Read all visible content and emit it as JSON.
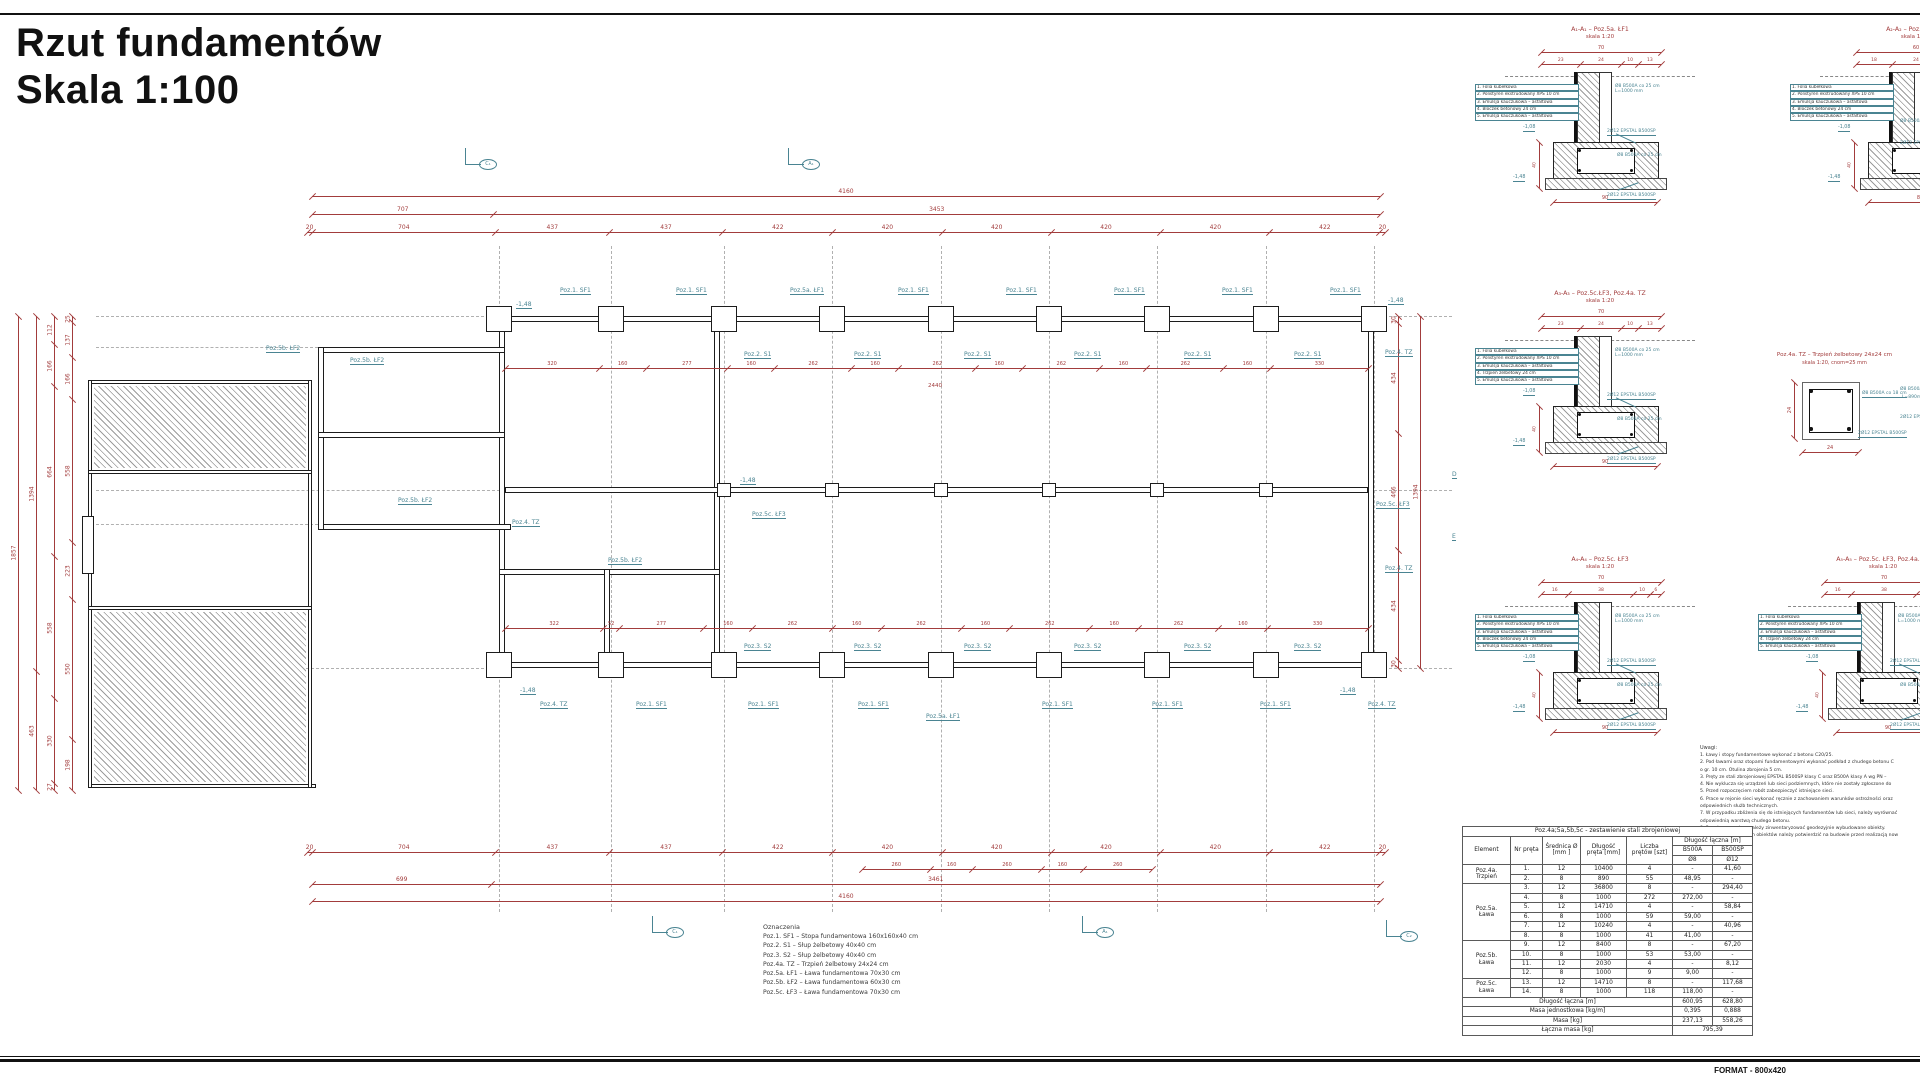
{
  "colors": {
    "dim_red": "#A23C3C",
    "annot_teal": "#4A8492",
    "line": "#1C1C1C",
    "grid": "#B0B0B0"
  },
  "header": {
    "title_line1": "Rzut fundamentów",
    "title_line2": "Skala 1:100"
  },
  "footer": {
    "format_label": "FORMAT - 800x420"
  },
  "plan": {
    "h_chains": [
      {
        "x": 312,
        "y": 196,
        "w": 1068,
        "vals": [
          "4160"
        ]
      },
      {
        "x": 312,
        "y": 214,
        "w": 1068,
        "vals": [
          "707",
          "3453"
        ]
      },
      {
        "x": 307,
        "y": 232,
        "w": 1078,
        "vals": [
          "20",
          "704",
          "437",
          "437",
          "422",
          "420",
          "420",
          "420",
          "420",
          "422",
          "20"
        ]
      },
      {
        "x": 307,
        "y": 852,
        "w": 1078,
        "vals": [
          "20",
          "704",
          "437",
          "437",
          "422",
          "420",
          "420",
          "420",
          "420",
          "422",
          "20"
        ]
      },
      {
        "x": 862,
        "y": 869,
        "w": 290,
        "vals": [
          "260",
          "160",
          "260",
          "160",
          "260"
        ],
        "fs": 5
      },
      {
        "x": 312,
        "y": 884,
        "w": 1068,
        "vals": [
          "699",
          "3461"
        ]
      },
      {
        "x": 312,
        "y": 901,
        "w": 1068,
        "vals": [
          "4160"
        ]
      },
      {
        "x": 505,
        "y": 368,
        "w": 863,
        "vals": [
          "320",
          "160",
          "277",
          "160",
          "262",
          "160",
          "262",
          "160",
          "262",
          "160",
          "262",
          "160",
          "330"
        ],
        "fs": 5
      },
      {
        "x": 505,
        "y": 628,
        "w": 863,
        "vals": [
          "322",
          "52",
          "277",
          "160",
          "262",
          "160",
          "262",
          "160",
          "262",
          "160",
          "262",
          "160",
          "330"
        ],
        "fs": 5
      }
    ],
    "v_chains": [
      {
        "x": 18,
        "y": 316,
        "h": 474,
        "vals": [
          "1857"
        ]
      },
      {
        "x": 36,
        "y": 316,
        "h": 474,
        "vals": [
          "1394",
          "463"
        ]
      },
      {
        "x": 54,
        "y": 316,
        "h": 474,
        "vals": [
          "112",
          "166",
          "664",
          "558",
          "330",
          "27"
        ]
      },
      {
        "x": 72,
        "y": 316,
        "h": 474,
        "vals": [
          "25",
          "137",
          "166",
          "558",
          "223",
          "550",
          "198"
        ]
      },
      {
        "x": 1398,
        "y": 316,
        "h": 352,
        "vals": [
          "30",
          "434",
          "466",
          "434",
          "30"
        ]
      },
      {
        "x": 1420,
        "y": 316,
        "h": 352,
        "vals": [
          "1394"
        ]
      }
    ],
    "grid_cols": {
      "xs": [
        499,
        611,
        724,
        832,
        941,
        1049,
        1157,
        1266,
        1374
      ],
      "y1": 246,
      "y2": 912
    },
    "grid_rows": [
      [
        96,
        316,
        499
      ],
      [
        96,
        490,
        505
      ],
      [
        96,
        668,
        499
      ],
      [
        96,
        347,
        318
      ],
      [
        96,
        524,
        318
      ],
      [
        1374,
        316,
        1452
      ],
      [
        1374,
        490,
        1452
      ],
      [
        1374,
        668,
        1452
      ]
    ],
    "walls": [
      [
        499,
        316,
        875,
        6
      ],
      [
        499,
        662,
        875,
        6
      ],
      [
        499,
        316,
        6,
        352
      ],
      [
        1368,
        316,
        6,
        352
      ],
      [
        714,
        316,
        6,
        352
      ],
      [
        499,
        569,
        221,
        6
      ],
      [
        604,
        569,
        6,
        99
      ],
      [
        505,
        487,
        863,
        6
      ],
      [
        318,
        347,
        187,
        6
      ],
      [
        318,
        524,
        193,
        6
      ],
      [
        318,
        347,
        6,
        183
      ],
      [
        318,
        432,
        187,
        6
      ],
      [
        88,
        380,
        224,
        4
      ],
      [
        88,
        784,
        228,
        4
      ],
      [
        88,
        380,
        4,
        408
      ],
      [
        308,
        380,
        4,
        408
      ],
      [
        88,
        470,
        224,
        4
      ],
      [
        88,
        606,
        224,
        4
      ],
      [
        82,
        516,
        12,
        58
      ]
    ],
    "hatch_areas": [
      [
        94,
        386,
        212,
        82
      ],
      [
        94,
        612,
        212,
        170
      ]
    ],
    "footings": {
      "size": 26,
      "top_y": 319,
      "bottom_y": 665,
      "mid_y": 490,
      "top_xs": [
        499,
        611,
        724,
        832,
        941,
        1049,
        1157,
        1266,
        1374
      ],
      "bottom_xs": [
        499,
        611,
        724,
        832,
        941,
        1049,
        1157,
        1266,
        1374
      ],
      "mid_xs": [
        724,
        832,
        941,
        1049,
        1157,
        1266
      ]
    },
    "labels": [
      [
        "Poz.1. SF1",
        560,
        288
      ],
      [
        "Poz.1. SF1",
        676,
        288
      ],
      [
        "Poz.5a. ŁF1",
        790,
        288
      ],
      [
        "Poz.1. SF1",
        898,
        288
      ],
      [
        "Poz.1. SF1",
        1006,
        288
      ],
      [
        "Poz.1. SF1",
        1114,
        288
      ],
      [
        "Poz.1. SF1",
        1222,
        288
      ],
      [
        "Poz.1. SF1",
        1330,
        288
      ],
      [
        "-1,48",
        516,
        302
      ],
      [
        "-1,48",
        1388,
        298
      ],
      [
        "Poz.5b. ŁF2",
        266,
        346
      ],
      [
        "Poz.5b. ŁF2",
        350,
        358
      ],
      [
        "Poz.5b. ŁF2",
        398,
        498
      ],
      [
        "Poz.5b. ŁF2",
        608,
        558
      ],
      [
        "Poz.2. S1",
        744,
        352
      ],
      [
        "Poz.2. S1",
        854,
        352
      ],
      [
        "Poz.2. S1",
        964,
        352
      ],
      [
        "Poz.2. S1",
        1074,
        352
      ],
      [
        "Poz.2. S1",
        1184,
        352
      ],
      [
        "Poz.2. S1",
        1294,
        352
      ],
      [
        "-1,48",
        740,
        478
      ],
      [
        "Poz.5c. ŁF3",
        752,
        512
      ],
      [
        "Poz.4. TZ",
        512,
        520
      ],
      [
        "Poz.4. TZ",
        1385,
        350
      ],
      [
        "Poz.4. TZ",
        1385,
        566
      ],
      [
        "Poz.5c. ŁF3",
        1376,
        502
      ],
      [
        "Poz.3. S2",
        744,
        644
      ],
      [
        "Poz.3. S2",
        854,
        644
      ],
      [
        "Poz.3. S2",
        964,
        644
      ],
      [
        "Poz.3. S2",
        1074,
        644
      ],
      [
        "Poz.3. S2",
        1184,
        644
      ],
      [
        "Poz.3. S2",
        1294,
        644
      ],
      [
        "-1,48",
        520,
        688
      ],
      [
        "-1,48",
        1340,
        688
      ],
      [
        "Poz.4. TZ",
        540,
        702
      ],
      [
        "Poz.1. SF1",
        636,
        702
      ],
      [
        "Poz.1. SF1",
        748,
        702
      ],
      [
        "Poz.1. SF1",
        858,
        702
      ],
      [
        "Poz.5a. ŁF1",
        926,
        714
      ],
      [
        "Poz.1. SF1",
        1042,
        702
      ],
      [
        "Poz.1. SF1",
        1152,
        702
      ],
      [
        "Poz.1. SF1",
        1260,
        702
      ],
      [
        "Poz.4. TZ",
        1368,
        702
      ],
      [
        "D",
        1452,
        472
      ],
      [
        "E",
        1452,
        534
      ]
    ],
    "red_texts": [
      [
        "2440",
        928,
        384
      ]
    ],
    "flags": [
      [
        "C₁",
        465,
        148
      ],
      [
        "A₁",
        788,
        148
      ],
      [
        "C₁",
        652,
        916
      ],
      [
        "A₁",
        1082,
        916
      ],
      [
        "C₂",
        1386,
        920
      ]
    ]
  },
  "details": {
    "common": {
      "rebar1": "Ø8 B500A co 25 cm",
      "rebar1b": "L=1000 mm",
      "rebar2": "2Ø12 EPSTAL B500SP",
      "rebar3": "Ø8 B500A co 25 cm",
      "rebar4": "2Ø12 EPSTAL B500SP",
      "side_dim": "40",
      "elev_top": "-1,08",
      "elev_bottom": "-1,48"
    },
    "materials_a": [
      "1. Folia kubełkowa",
      "2. Polistyren ekstrudowany XPS 10 cm",
      "3. Emulsja kauczukowa – asfaltowa",
      "4. Bloczek betonowy 24 cm",
      "5. Emulsja kauczukowa – asfaltowa"
    ],
    "materials_b": [
      "1. Folia kubełkowa",
      "2. Polistyren ekstrudowany XPS 10 cm",
      "3. Emulsja kauczukowa – asfaltowa",
      "4. Trzpień żelbetowy 24 cm",
      "5. Emulsja kauczukowa – asfaltowa"
    ],
    "items": [
      {
        "x": 1475,
        "y": 26,
        "title": "A₁-A₁ – Poz.5a. ŁF1",
        "subtitle": "skala 1:20",
        "total": "70",
        "segs": [
          "23",
          "24",
          "10",
          "13"
        ],
        "bottom": "90",
        "mat": "materials_a"
      },
      {
        "x": 1790,
        "y": 26,
        "title": "A₂-A₂ – Poz.5b. ŁF2",
        "subtitle": "skala 1:20",
        "total": "60",
        "segs": [
          "18",
          "24",
          "10",
          "8"
        ],
        "bottom": "80",
        "mat": "materials_a"
      },
      {
        "x": 1475,
        "y": 290,
        "title": "A₃-A₃ – Poz.5c.ŁF3, Poz.4a. TZ",
        "subtitle": "skala 1:20",
        "total": "70",
        "segs": [
          "23",
          "24",
          "10",
          "13"
        ],
        "bottom": "90",
        "mat": "materials_b"
      },
      {
        "x": 1475,
        "y": 556,
        "title": "A₄-A₄ – Poz.5c. ŁF3",
        "subtitle": "skala 1:20",
        "total": "70",
        "segs": [
          "16",
          "38",
          "10",
          "6"
        ],
        "bottom": "90",
        "mat": "materials_a"
      },
      {
        "x": 1758,
        "y": 556,
        "title": "A₅-A₅ – Poz.5c. ŁF3, Poz.4a. TZ",
        "subtitle": "skala 1:20",
        "total": "70",
        "segs": [
          "16",
          "38",
          "10",
          "6"
        ],
        "bottom": "90",
        "mat": "materials_b"
      }
    ],
    "stirrup": {
      "x": 1752,
      "y": 352,
      "title": "Poz.4a. TZ – Trzpień żelbetowy 24x24 cm",
      "subtitle": "skala 1:20, cnom=25 mm",
      "dim_w": "24",
      "dim_h": "24",
      "stirrup_label": "Ø8 B500A co 18 cm",
      "bars_label": "2Ø12 EPSTAL B500SP"
    },
    "edge_labels": [
      [
        "Ø8 B500A co 25 cm",
        1900,
        120
      ],
      [
        "2Ø12 EPSTAL B500SP",
        1900,
        142
      ],
      [
        "Ø8 B500A co 25 cm",
        1900,
        388
      ],
      [
        "L=890mm",
        1902,
        396
      ],
      [
        "2Ø12 EPSTAL B500SP",
        1900,
        416
      ]
    ]
  },
  "notes": {
    "heading": "Uwagi:",
    "lines": [
      "1. Ławy i stopy fundamentowe wykonać z betonu C20/25.",
      "2. Pod ławami oraz stopami fundamentowymi wykonać podkład z chudego betonu C",
      "o gr. 10 cm. Otulina zbrojenia 5 cm.",
      "3. Pręty ze stali zbrojeniowej EPSTAL B500SP klasy C oraz B500A klasy A wg PN –",
      "4. Nie wyklucza się urządzeń lub sieci podziemnych, które nie zostały zgłoszone do",
      "5. Przed rozpoczęciem robót zabezpieczyć istniejące sieci.",
      "6. Prace w rejonie sieci wykonać ręcznie z zachowaniem warunków ostrożności oraz",
      "odpowiednich służb technicznych.",
      "7. W przypadku zbliżenia się do istniejących fundamentów lub sieci, należy wyrównać",
      "odpowiednią warstwą chudego betonu.",
      "8. Przed zasypaniem należy zinwentaryzować geodezyjnie wybudowane obiekty.",
      "9. Wymiary istniejących obiektów należy potwierdzić na budowie przed realizacją now"
    ]
  },
  "steel_table": {
    "title": "Poz.4a;5a,5b,5c - zestawienie stali zbrojeniowej",
    "headers": {
      "element": "Element",
      "nr": "Nr pręta",
      "srednica": "Średnica Ø\n[mm ]",
      "dlugosc": "Długość\npręta [mm]",
      "liczba": "Liczba\nprętów [szt]",
      "laczna": "Długość łączna [m]",
      "b500a": "B500A",
      "b500sp": "B500SP",
      "fi8": "Ø8",
      "fi12": "Ø12"
    },
    "groups": [
      {
        "name": "Poz.4a.\nTrzpień",
        "rows": [
          [
            "1.",
            "12",
            "10400",
            "4",
            "-",
            "41,60"
          ],
          [
            "2.",
            "8",
            "890",
            "55",
            "48,95",
            "-"
          ]
        ]
      },
      {
        "name": "Poz.5a.\nŁawa",
        "rows": [
          [
            "3.",
            "12",
            "36800",
            "8",
            "-",
            "294,40"
          ],
          [
            "4.",
            "8",
            "1000",
            "272",
            "272,00",
            "-"
          ],
          [
            "5.",
            "12",
            "14710",
            "4",
            "-",
            "58,84"
          ],
          [
            "6.",
            "8",
            "1000",
            "59",
            "59,00",
            "-"
          ],
          [
            "7.",
            "12",
            "10240",
            "4",
            "-",
            "40,96"
          ],
          [
            "8.",
            "8",
            "1000",
            "41",
            "41,00",
            "-"
          ]
        ]
      },
      {
        "name": "Poz.5b.\nŁawa",
        "rows": [
          [
            "9.",
            "12",
            "8400",
            "8",
            "-",
            "67,20"
          ],
          [
            "10.",
            "8",
            "1000",
            "53",
            "53,00",
            "-"
          ],
          [
            "11.",
            "12",
            "2030",
            "4",
            "-",
            "8,12"
          ],
          [
            "12.",
            "8",
            "1000",
            "9",
            "9,00",
            "-"
          ]
        ]
      },
      {
        "name": "Poz.5c.\nŁawa",
        "rows": [
          [
            "13.",
            "12",
            "14710",
            "8",
            "-",
            "117,68"
          ],
          [
            "14.",
            "8",
            "1000",
            "118",
            "118,00",
            "-"
          ]
        ]
      }
    ],
    "footer": [
      [
        "Długość łączna [m]",
        "600,95",
        "628,80"
      ],
      [
        "Masa jednostkowa [kg/m]",
        "0,395",
        "0,888"
      ],
      [
        "Masa [kg]",
        "237,13",
        "558,26"
      ]
    ],
    "total_row": [
      "Łączna masa [kg]",
      "795,39"
    ]
  },
  "legend": {
    "heading": "Oznaczenia",
    "items": [
      "Poz.1. SF1 – Stopa fundamentowa 160x160x40 cm",
      "Poz.2. S1 – Słup żelbetowy 40x40 cm",
      "Poz.3. S2 – Słup żelbetowy 40x40 cm",
      "Poz.4a. TZ – Trzpień żelbetowy 24x24 cm",
      "Poz.5a. ŁF1 – Ława fundamentowa 70x30 cm",
      "Poz.5b. ŁF2 – Ława fundamentowa 60x30 cm",
      "Poz.5c. ŁF3 – Ława fundamentowa 70x30 cm"
    ]
  }
}
